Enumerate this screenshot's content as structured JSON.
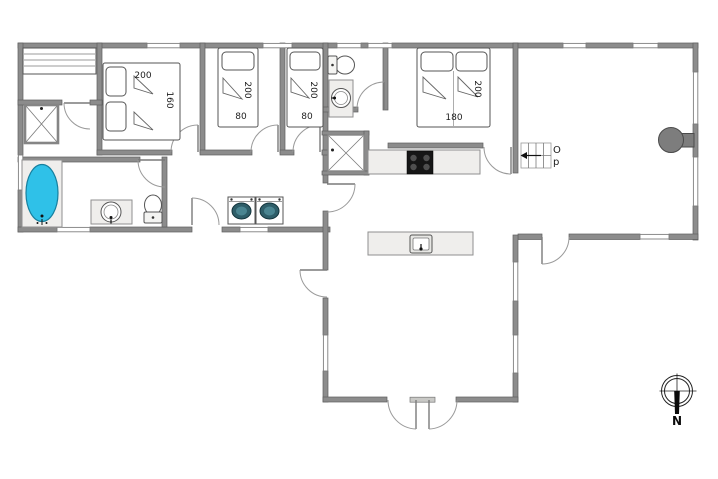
{
  "beds": {
    "master": {
      "length": "200",
      "width": "160"
    },
    "single1": {
      "length": "200",
      "width": "80"
    },
    "single2": {
      "length": "200",
      "width": "80"
    },
    "double": {
      "length": "200",
      "width": "180"
    }
  },
  "stairs": {
    "direction_top": "O",
    "direction_bottom": "p"
  },
  "compass": {
    "north": "N"
  },
  "colors": {
    "bathtub": "#2fc1e8",
    "washer_lid": "#2e5e69",
    "washer_lid_inner": "#4a8591",
    "stove": "#161616",
    "wood_stove": "#7d7d7d"
  }
}
